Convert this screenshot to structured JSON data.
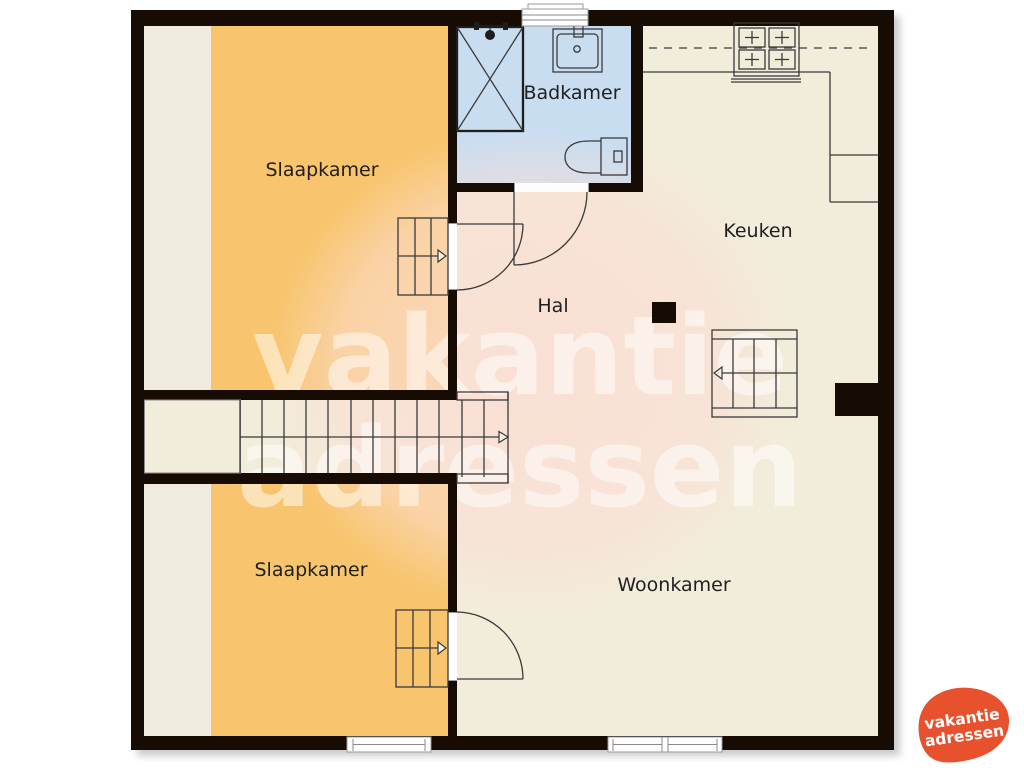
{
  "rooms": {
    "bedroom_top": "Slaapkamer",
    "bathroom": "Badkamer",
    "kitchen": "Keuken",
    "hall": "Hal",
    "bedroom_bottom": "Slaapkamer",
    "living_room": "Woonkamer"
  },
  "watermark": {
    "line1": "vakantie",
    "line2": "adressen"
  },
  "logo": {
    "line1": "vakantie",
    "line2": "adressen"
  },
  "colors": {
    "wall": "#160c03",
    "floor": "#f2ecdb",
    "bedroom_floor": "#f8c56e",
    "bedroom_strip": "#f0ebdf",
    "bathroom_floor": "#c9ddf1",
    "label_text": "#1f1f1f",
    "line": "#3a3a3a",
    "logo_orange": "#e8512e",
    "watermark_text": "#ffffff"
  }
}
